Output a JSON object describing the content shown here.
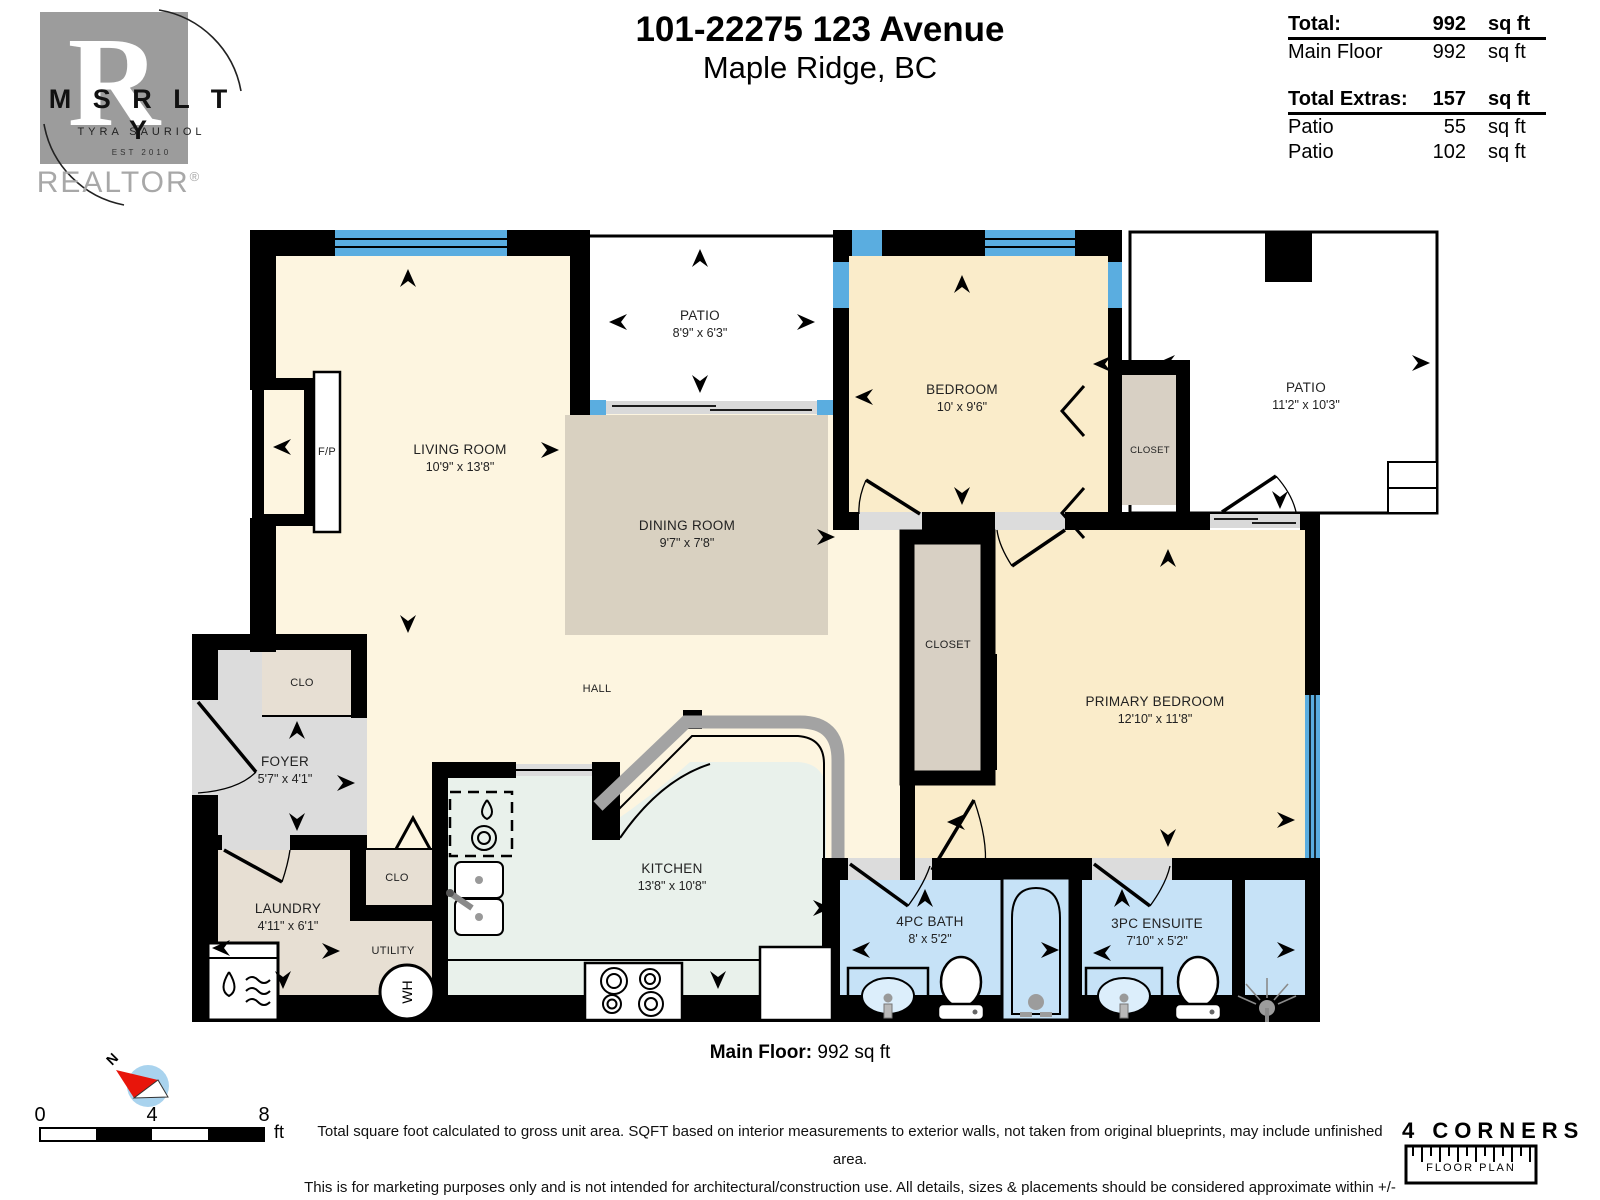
{
  "header": {
    "logo": {
      "letters": "M S R L T Y",
      "big_letter": "R",
      "name": "TYRA SAURIOL",
      "est": "EST 2010",
      "realtor": "REALTOR",
      "registered": "®"
    },
    "title_line1": "101-22275 123 Avenue",
    "title_line2": "Maple Ridge, BC",
    "area_table": {
      "total_label": "Total:",
      "total_value": "992",
      "total_unit": "sq ft",
      "main_floor_label": "Main Floor",
      "main_floor_value": "992",
      "main_floor_unit": "sq ft",
      "extras_label": "Total Extras:",
      "extras_value": "157",
      "extras_unit": "sq ft",
      "extra1_label": "Patio",
      "extra1_value": "55",
      "extra1_unit": "sq ft",
      "extra2_label": "Patio",
      "extra2_value": "102",
      "extra2_unit": "sq ft"
    }
  },
  "rooms": {
    "living": {
      "name": "LIVING ROOM",
      "dims": "10'9\" x 13'8\""
    },
    "patio_top": {
      "name": "PATIO",
      "dims": "8'9\" x 6'3\""
    },
    "dining": {
      "name": "DINING ROOM",
      "dims": "9'7\" x 7'8\""
    },
    "bedroom": {
      "name": "BEDROOM",
      "dims": "10' x 9'6\""
    },
    "patio_right": {
      "name": "PATIO",
      "dims": "11'2\" x 10'3\""
    },
    "bedroom_closet": {
      "name": "CLOSET"
    },
    "primary": {
      "name": "PRIMARY BEDROOM",
      "dims": "12'10\" x 11'8\""
    },
    "central_closet": {
      "name": "CLOSET"
    },
    "hall": {
      "name": "HALL"
    },
    "foyer": {
      "name": "FOYER",
      "dims": "5'7\" x 4'1\""
    },
    "clo_top": {
      "name": "CLO"
    },
    "laundry": {
      "name": "LAUNDRY",
      "dims": "4'11\" x 6'1\""
    },
    "clo_lower": {
      "name": "CLO"
    },
    "utility": {
      "name": "UTILITY"
    },
    "kitchen": {
      "name": "KITCHEN",
      "dims": "13'8\" x 10'8\""
    },
    "bath": {
      "name": "4PC BATH",
      "dims": "8' x 5'2\""
    },
    "ensuite": {
      "name": "3PC ENSUITE",
      "dims": "7'10\" x 5'2\""
    },
    "fireplace": {
      "name": "F/P"
    },
    "water_heater": {
      "name": "WH"
    }
  },
  "footer": {
    "floor_label": "Main Floor:",
    "floor_value": "992 sq ft",
    "disclaimer_line1": "Total square foot calculated to gross unit area. SQFT based on interior measurements to exterior walls, not taken from original blueprints, may include unfinished area.",
    "disclaimer_line2": "This is for marketing purposes only and is not intended for architectural/construction use.  All details, sizes & placements should be considered approximate within +/- 2%  tolerance.",
    "scale": {
      "start": "0",
      "mid": "4",
      "end": "8",
      "unit": "ft"
    },
    "compass_north": "N",
    "brand_line1": "4 CORNERS",
    "brand_line2": "FLOOR PLAN"
  },
  "colors": {
    "wall": "#000000",
    "window_blue": "#5aade0",
    "living_cream": "#fdf5e0",
    "bedroom_cream": "#faecca",
    "dining_tan": "#d9d1c1",
    "laundry_tan": "#e7dfd3",
    "closet_tan": "#d8d0c4",
    "foyer_grey": "#dcdcdc",
    "kitchen_mint": "#e9f1eb",
    "bath_blue": "#c6e2f7",
    "counter_grey": "#a3a3a3",
    "compass_blue": "#a9d3ee",
    "needle_red": "#e8150b"
  }
}
